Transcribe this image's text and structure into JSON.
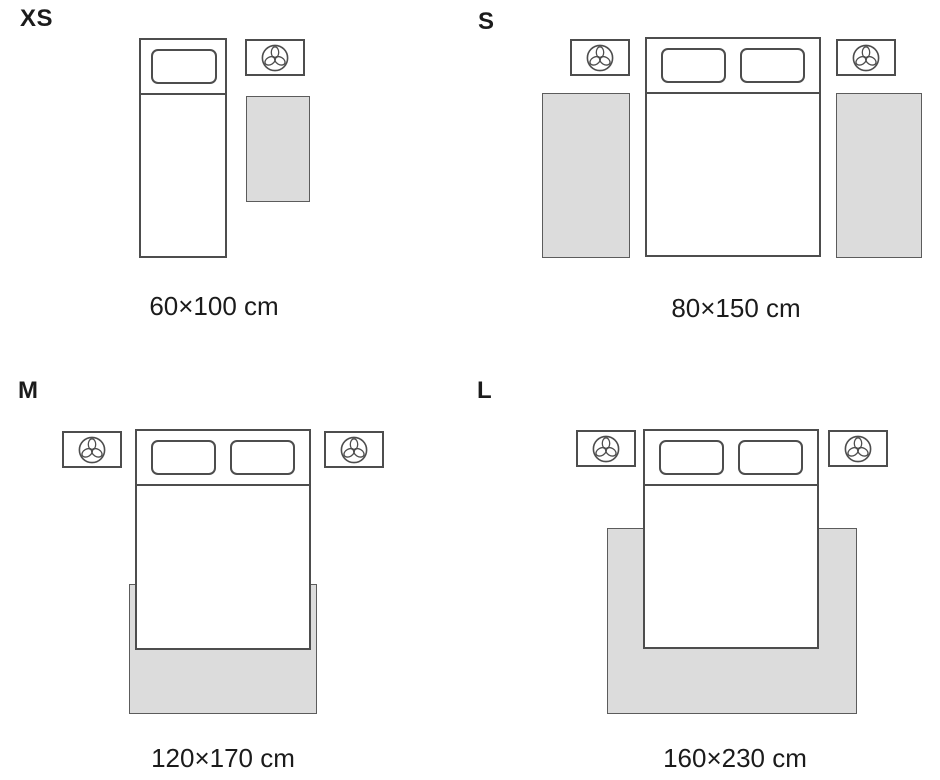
{
  "colors": {
    "background": "#ffffff",
    "outline": "#4d4d4d",
    "rug_fill": "#dcdcdc",
    "rug_border": "#5c5c5c",
    "text": "#1b1b1b"
  },
  "icons": {
    "nightstand": "lamp-top-view-icon"
  },
  "quadrants": [
    {
      "letter": "XS",
      "size_label": "60×100 cm"
    },
    {
      "letter": "S",
      "size_label": "80×150 cm"
    },
    {
      "letter": "M",
      "size_label": "120×170 cm"
    },
    {
      "letter": "L",
      "size_label": "160×230 cm"
    }
  ]
}
